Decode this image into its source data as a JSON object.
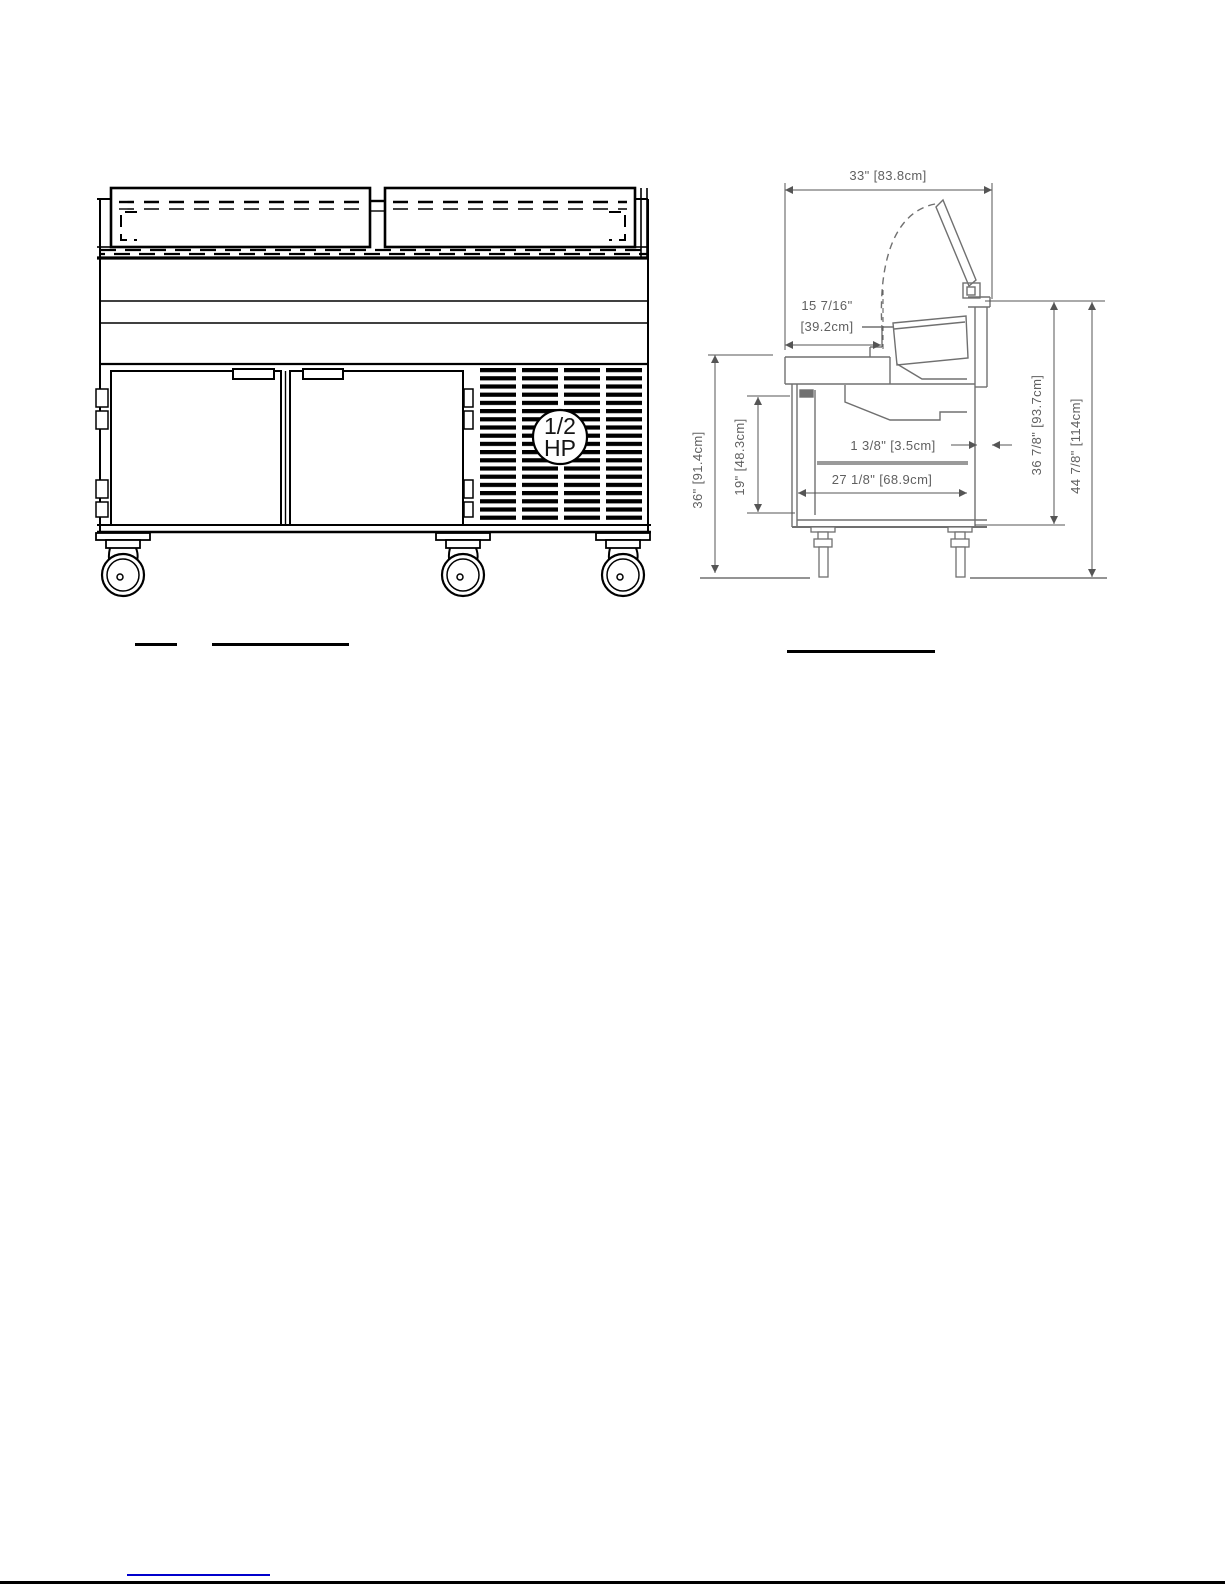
{
  "front_view": {
    "hp_badge": {
      "line1": "1/2",
      "line2": "HP"
    }
  },
  "side_view": {
    "dims": {
      "overall_depth": "33\" [83.8cm]",
      "cutting_board_line1": "15 7/16\"",
      "cutting_board_line2": "[39.2cm]",
      "wall_thickness": "1 3/8\" [3.5cm]",
      "interior_depth": "27 1/8\" [68.9cm]",
      "work_height": "36\" [91.4cm]",
      "interior_height": "19\" [48.3cm]",
      "rail_height": "36 7/8\" [93.7cm]",
      "overall_height": "44 7/8\" [114cm]"
    }
  },
  "colors": {
    "link_underline": "#0000cc",
    "side_line_gray": "#707070",
    "front_line_black": "#000000"
  }
}
